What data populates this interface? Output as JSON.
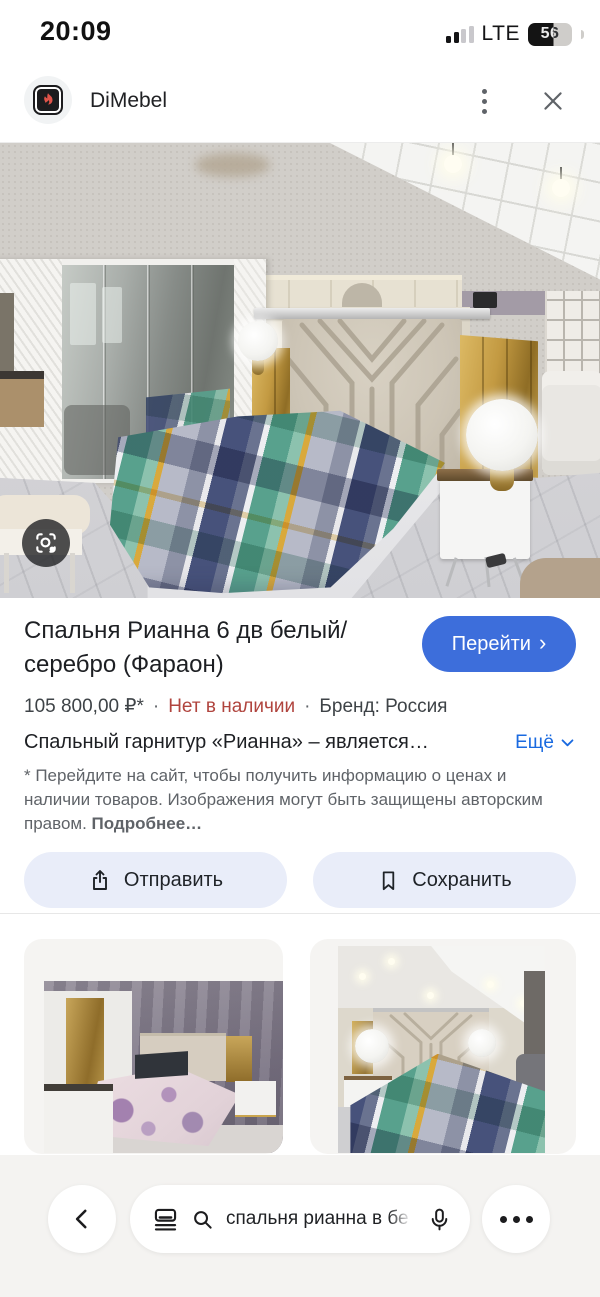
{
  "status_bar": {
    "time": "20:09",
    "network_label": "LTE",
    "battery_percent": "56"
  },
  "header": {
    "source_name": "DiMebel"
  },
  "product": {
    "title": "Спальня Рианна 6 дв белый/серебро (Фараон)",
    "visit_button_label": "Перейти",
    "visit_button_chevron": "›",
    "price": "105 800,00 ₽*",
    "dot_separator": "·",
    "availability": "Нет в наличии",
    "brand": "Бренд: Россия",
    "description_preview": "Спальный гарнитур «Рианна» – является…",
    "more_label": "Ещё",
    "disclaimer_text": "* Перейдите на сайт, чтобы получить информацию о ценах и наличии товаров. Изображения могут быть защищены авторским правом. ",
    "disclaimer_more_label": "Подробнее…",
    "share_button_label": "Отправить",
    "save_button_label": "Сохранить"
  },
  "bottom_bar": {
    "search_query": "спальня рианна в бе"
  },
  "icons": {
    "lens": "camera-viewfinder",
    "share": "share-up-arrow",
    "save": "bookmark",
    "search": "magnifier",
    "voice": "microphone"
  },
  "colors": {
    "accent_blue": "#3d6edb",
    "link_blue": "#1a6ae0",
    "availability_red": "#b0443e",
    "pill_button_bg": "#e9edf9",
    "text_primary": "#202124",
    "text_secondary": "#5f6368",
    "bottom_bar_bg": "#f4f3f1"
  }
}
